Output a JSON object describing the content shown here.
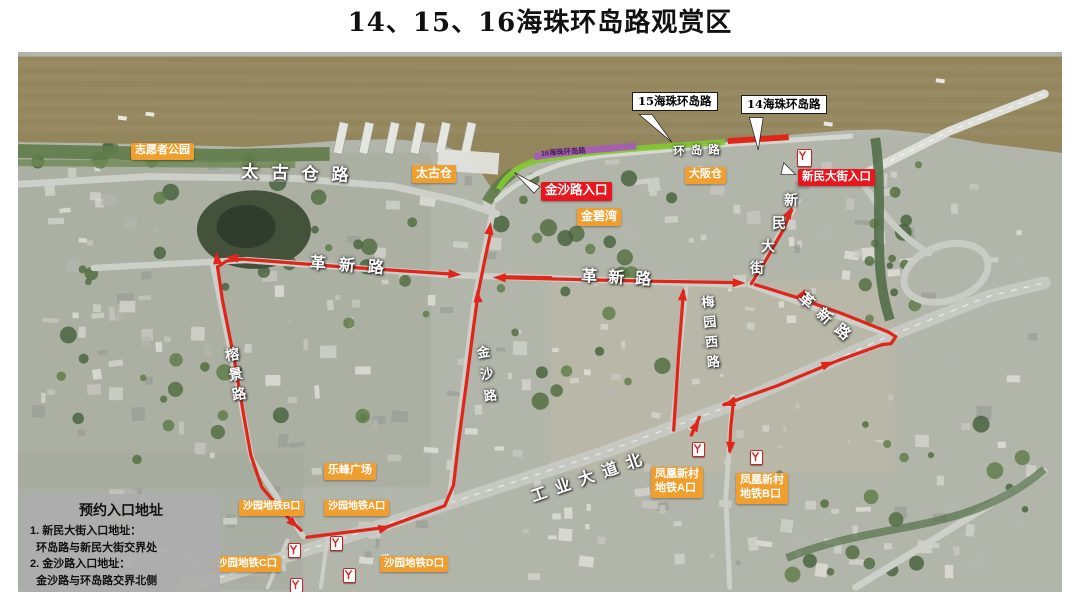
{
  "title": "14、15、16海珠环岛路观赏区",
  "map": {
    "colors": {
      "route_red": "#e1251b",
      "poi_orange": "#f09e2d",
      "entrance_red": "#e8161d",
      "segment14_red": "#e1251b",
      "segment15_green": "#82c832",
      "segment16_purple": "#a55cb5",
      "water_brown": "#93855c",
      "land_gray_green": "#b2b5aa"
    },
    "white_callouts": [
      {
        "id": "callout-15-haizhu-huandao-road",
        "text": "15海珠环岛路",
        "x": 632,
        "y": 92
      },
      {
        "id": "callout-14-haizhu-huandao-road",
        "text": "14海珠环岛路",
        "x": 741,
        "y": 95
      }
    ],
    "segment16_band_label": {
      "id": "segment-16-label",
      "text": "16海珠环岛路",
      "x": 550,
      "y": 153
    },
    "entrance_labels": [
      {
        "id": "jinsha-road-entrance",
        "text": "金沙路入口",
        "x": 541,
        "y": 182,
        "size": 12.5
      },
      {
        "id": "xinmin-street-entrance",
        "text": "新民大街入口",
        "x": 798,
        "y": 169,
        "size": 11.5
      }
    ],
    "poi_labels": [
      {
        "id": "volunteer-park",
        "text": "志愿者公园",
        "x": 131,
        "y": 143,
        "size": 11
      },
      {
        "id": "taikoo-warehouse",
        "text": "太古仓",
        "x": 412,
        "y": 165,
        "size": 12
      },
      {
        "id": "daban-warehouse",
        "text": "大阪仓",
        "x": 685,
        "y": 167,
        "size": 11
      },
      {
        "id": "jinbiwan",
        "text": "金碧湾",
        "x": 577,
        "y": 208,
        "size": 12
      },
      {
        "id": "lefeng-plaza",
        "text": "乐峰广场",
        "x": 324,
        "y": 463,
        "size": 11
      },
      {
        "id": "shayuan-metro-exit-b",
        "text": "沙园地铁B口",
        "x": 239,
        "y": 500,
        "size": 10
      },
      {
        "id": "shayuan-metro-exit-a",
        "text": "沙园地铁A口",
        "x": 324,
        "y": 500,
        "size": 10
      },
      {
        "id": "shayuan-metro-exit-c",
        "text": "沙园地铁C口",
        "x": 213,
        "y": 556,
        "size": 10.5
      },
      {
        "id": "shayuan-metro-exit-d",
        "text": "沙园地铁D口",
        "x": 380,
        "y": 556,
        "size": 10.5
      },
      {
        "id": "fenghuangxincun-metro-exit-a",
        "text": "凤凰新村\n地铁A口",
        "x": 651,
        "y": 467,
        "size": 11
      },
      {
        "id": "fenghuangxincun-metro-exit-b",
        "text": "凤凰新村\n地铁B口",
        "x": 736,
        "y": 473,
        "size": 11
      }
    ],
    "road_labels": [
      {
        "id": "road-taigucang",
        "text": "太古仓路",
        "x": 242,
        "y": 157,
        "size": 17,
        "spacing": 13,
        "rotate": 2
      },
      {
        "id": "road-huandao",
        "text": "环岛路",
        "x": 673,
        "y": 143,
        "size": 11.5,
        "spacing": 6,
        "rotate": -2
      },
      {
        "id": "road-gexin-west",
        "text": "革新路",
        "x": 311,
        "y": 249,
        "size": 16,
        "spacing": 13,
        "rotate": 4
      },
      {
        "id": "road-gexin-mid",
        "text": "革新路",
        "x": 582,
        "y": 262,
        "size": 16,
        "spacing": 11,
        "rotate": 3
      },
      {
        "id": "road-gexin-east",
        "text": "革新路",
        "x": 808,
        "y": 287,
        "size": 15,
        "spacing": 9,
        "rotate": 41
      },
      {
        "id": "road-gongye-dadao-north",
        "text": "工业大道北",
        "x": 527,
        "y": 484,
        "size": 16,
        "spacing": 9,
        "rotate": -19
      },
      {
        "id": "road-meiyuanxi",
        "text": "梅园西路",
        "x": 697,
        "y": 296,
        "size": 13,
        "spacing": 7,
        "rotate": -5,
        "vertical": true
      },
      {
        "id": "road-jinsha",
        "text": "金沙路",
        "x": 472,
        "y": 347,
        "size": 13,
        "spacing": 9,
        "rotate": -9,
        "vertical": true
      },
      {
        "id": "road-rongjing",
        "text": "榕景路",
        "x": 221,
        "y": 349,
        "size": 14,
        "spacing": 6,
        "rotate": -10,
        "vertical": true
      },
      {
        "id": "road-xinmin-street",
        "text": "新民大街",
        "size": 14,
        "chars": [
          [
            784,
            190
          ],
          [
            772,
            213
          ],
          [
            761,
            236
          ],
          [
            750,
            258
          ]
        ]
      }
    ],
    "metro_icons": [
      {
        "id": "metro-icon-shayuan-1",
        "x": 288,
        "y": 543
      },
      {
        "id": "metro-icon-shayuan-2",
        "x": 330,
        "y": 536
      },
      {
        "id": "metro-icon-shayuan-3",
        "x": 343,
        "y": 568
      },
      {
        "id": "metro-icon-shayuan-4",
        "x": 290,
        "y": 578
      },
      {
        "id": "metro-icon-fenghuang-1",
        "x": 692,
        "y": 442
      },
      {
        "id": "metro-icon-fenghuang-2",
        "x": 750,
        "y": 450
      },
      {
        "id": "metro-icon-xinmin",
        "x": 797,
        "y": 149,
        "big": true
      }
    ],
    "info_box": {
      "title": "预约入口地址",
      "lines": [
        "1. 新民大街入口地址：",
        "  环岛路与新民大街交界处",
        "2. 金沙路入口地址：",
        "  金沙路与环岛路交界北侧"
      ]
    }
  }
}
